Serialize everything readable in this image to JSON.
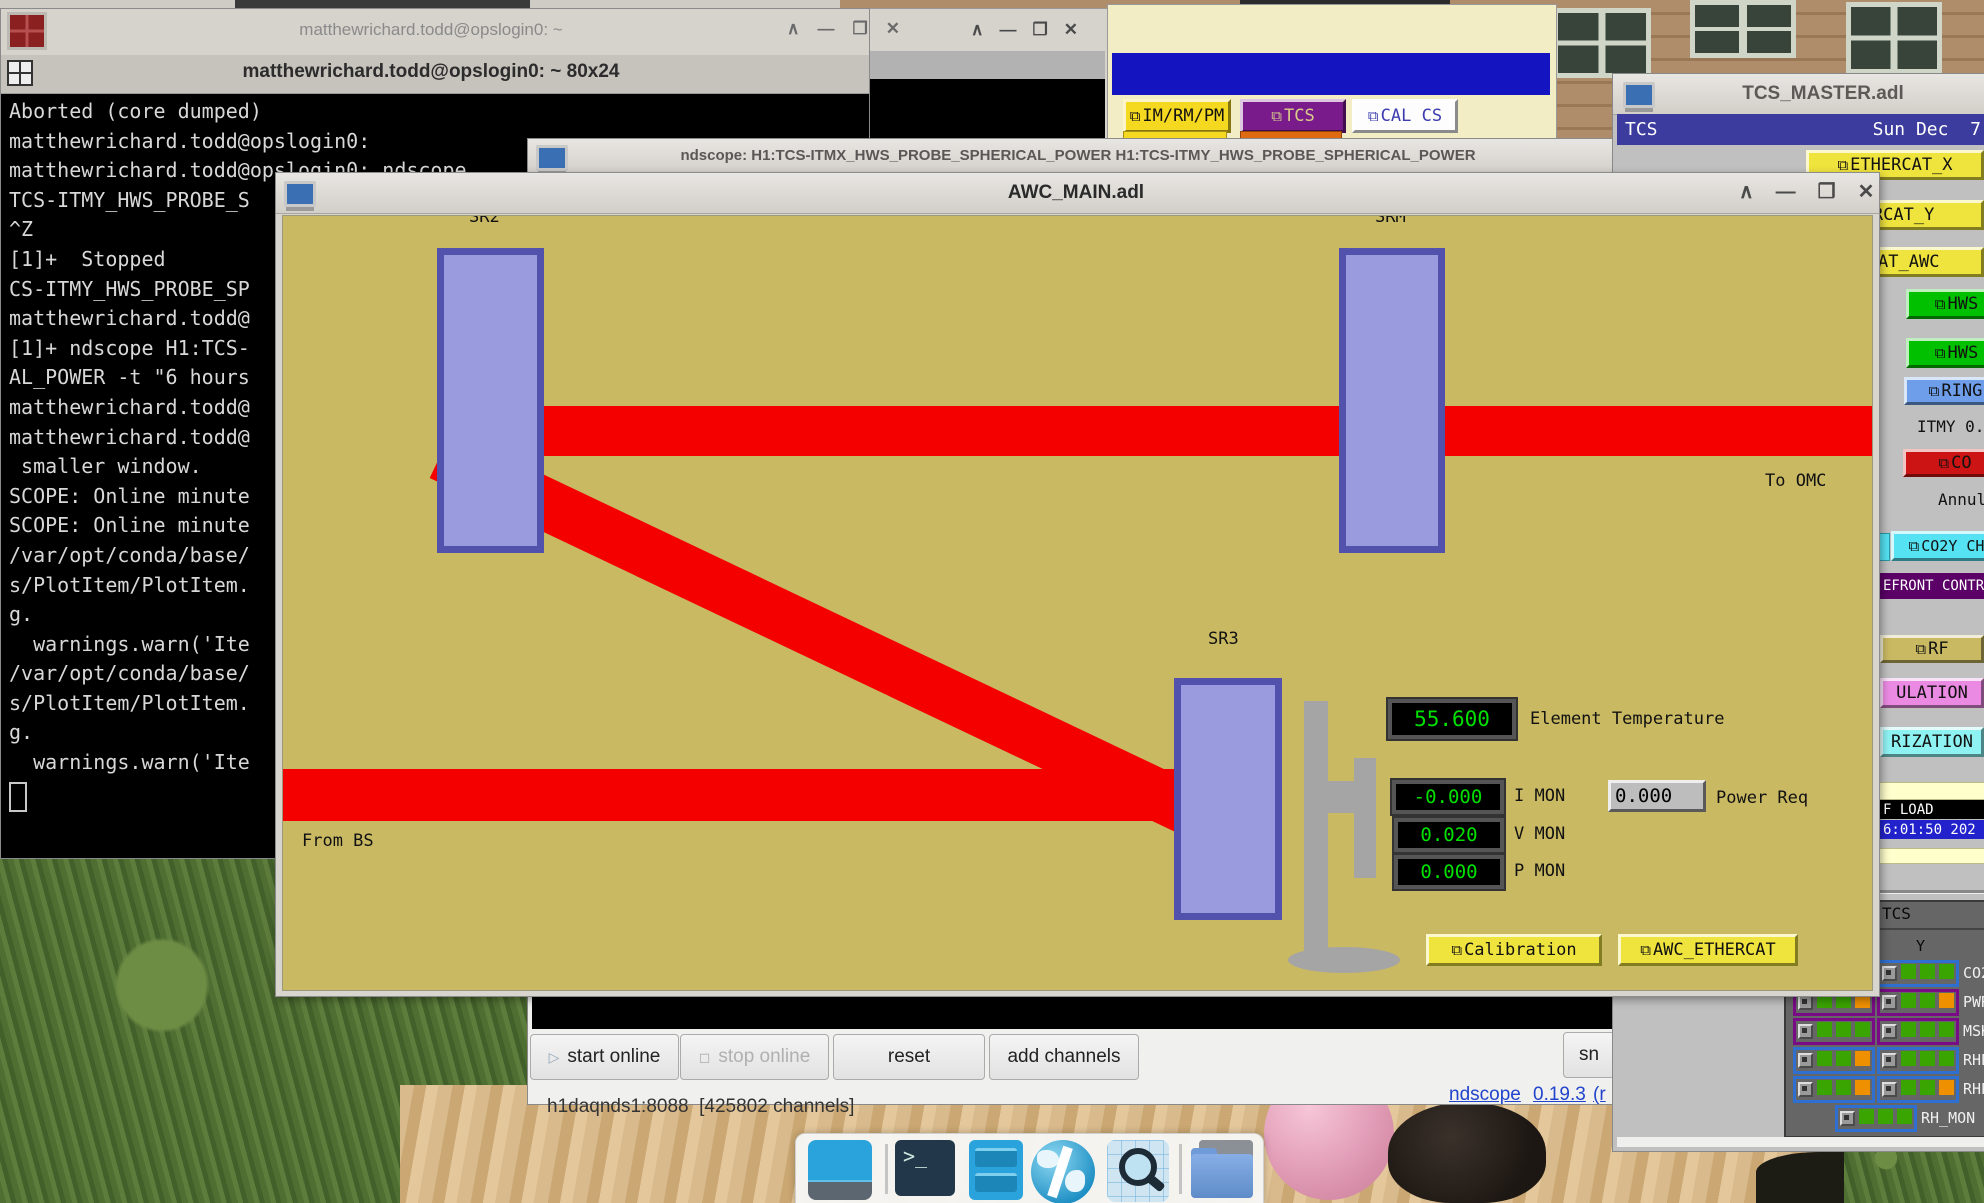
{
  "colors": {
    "medm_tan": "#c9b963",
    "beam_red": "#f40000",
    "mirror_fill": "#9a9ade",
    "mirror_border": "#5252ac",
    "led_green": "#00e000",
    "medm_yellow": "#efe33e",
    "medm_green": "#00c000",
    "medm_blue_button": "#6e9eea",
    "medm_red_button": "#cc1414",
    "medm_cyan": "#55e2f2",
    "medm_purple_banner": "#5a0066",
    "medm_pink": "#ea8ae2",
    "header_blue": "#3c3c9e",
    "indicator_green": "#3aa400",
    "indicator_orange": "#ef9000"
  },
  "icons": {
    "shade": "∧",
    "minimize": "—",
    "maximize": "❒",
    "close": "✕",
    "related_display": "⧉",
    "play": "▷",
    "stop": "◻"
  },
  "terminal": {
    "title": "matthewrichard.todd@opslogin0: ~",
    "tab_title": "matthewrichard.todd@opslogin0: ~ 80x24",
    "lines": [
      "Aborted (core dumped)",
      "matthewrichard.todd@opslogin0:",
      "matthewrichard.todd@opslogin0: ndscope",
      "TCS-ITMY_HWS_PROBE_S",
      "^Z",
      "[1]+  Stopped",
      "CS-ITMY_HWS_PROBE_SP",
      "matthewrichard.todd@",
      "[1]+ ndscope H1:TCS-",
      "AL_POWER -t \"6 hours",
      "matthewrichard.todd@",
      "matthewrichard.todd@",
      " smaller window.",
      "SCOPE: Online minute",
      "SCOPE: Online minute",
      "/var/opt/conda/base/",
      "s/PlotItem/PlotItem.",
      "g.",
      "  warnings.warn('Ite",
      "/var/opt/conda/base/",
      "s/PlotItem/PlotItem.",
      "g.",
      "  warnings.warn('Ite"
    ]
  },
  "sitemap": {
    "buttons": [
      {
        "label": "IM/RM/PM"
      },
      {
        "label": "TCS"
      },
      {
        "label": "CAL CS"
      }
    ]
  },
  "ndscope": {
    "title": "ndscope: H1:TCS-ITMX_HWS_PROBE_SPHERICAL_POWER H1:TCS-ITMY_HWS_PROBE_SPHERICAL_POWER",
    "buttons": {
      "start": "start online",
      "stop": "stop online",
      "reset": "reset",
      "add": "add channels",
      "snapshot": "sn"
    },
    "status": "h1daqnds1:8088  [425802 channels]",
    "links": [
      "ndscope",
      "0.19.3",
      "(r"
    ]
  },
  "awc": {
    "title": "AWC_MAIN.adl",
    "mirrors": {
      "sr2": "SR2",
      "srm": "SRM",
      "sr3": "SR3"
    },
    "labels": {
      "to_omc": "To OMC",
      "from_bs": "From BS",
      "element_temp": "Element Temperature",
      "i_mon": "I MON",
      "v_mon": "V MON",
      "p_mon": "P MON",
      "power_req": "Power Req"
    },
    "readouts": {
      "element_temp": "55.600",
      "i_mon": "-0.000",
      "v_mon": "0.020",
      "p_mon": "0.000"
    },
    "power_req_value": "0.000",
    "buttons": {
      "calibration": "Calibration",
      "awc_ethercat": "AWC_ETHERCAT"
    }
  },
  "tcs": {
    "title": "TCS_MASTER.adl",
    "header": {
      "left": "TCS",
      "right": "Sun Dec  7"
    },
    "buttons": {
      "ethercat_x": "ETHERCAT_X",
      "ethercat_y": "ERCAT_Y",
      "ethercat_awc": "RCAT_AWC",
      "hws1": "HWS",
      "hws2": "HWS",
      "ring": "RING",
      "co2": "CO",
      "co2y": "CO2Y CH",
      "rf": "RF",
      "modulation": "ULATION",
      "polarization": "RIZATION"
    },
    "labels": {
      "itmy": "ITMY 0.0",
      "annulus": "Annul",
      "wavefront": "EFRONT CONTR",
      "ref_load": "F LOAD",
      "timestamp": "6:01:50 202"
    },
    "panel": {
      "title": "TCS",
      "column": "Y",
      "rows": [
        {
          "label": "CO2",
          "frame": "blue",
          "right": [
            "green",
            "green",
            "green"
          ]
        },
        {
          "label": "PWR",
          "frame": "purple",
          "left": [
            "green",
            "green",
            "orange"
          ],
          "right": [
            "green",
            "green",
            "orange"
          ]
        },
        {
          "label": "MSK",
          "frame": "purple",
          "left": [
            "green",
            "green",
            "green"
          ],
          "right": [
            "green",
            "green",
            "green"
          ]
        },
        {
          "label": "RHP",
          "frame": "blue",
          "left": [
            "green",
            "green",
            "orange"
          ],
          "right": [
            "green",
            "green",
            "green"
          ]
        },
        {
          "label": "RHP",
          "frame": "blue",
          "left": [
            "green",
            "green",
            "orange"
          ],
          "right": [
            "green",
            "green",
            "orange"
          ]
        },
        {
          "label": "RH_MON",
          "frame": "blue",
          "center": [
            "green",
            "green",
            "green"
          ]
        }
      ]
    }
  }
}
